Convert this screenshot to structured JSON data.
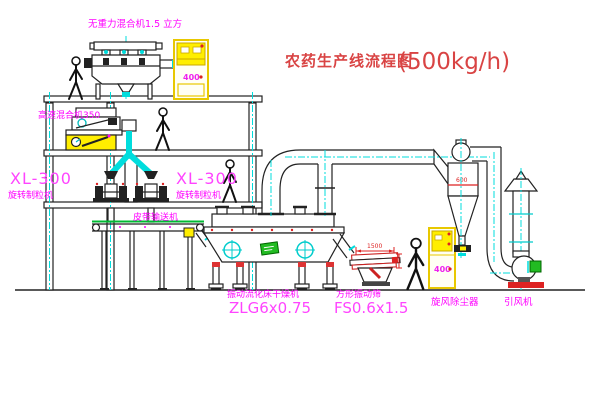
{
  "title": {
    "text_cn": "农药生产线流程图",
    "capacity": "(500kg/h)"
  },
  "labels": {
    "gravity_mixer": "无重力混合机1.5 立方",
    "high_speed_mixer": "高速混合机350",
    "granulator_left_model": "XL-300",
    "granulator_left_name": "旋转制粒机",
    "granulator_mid_model": "XL-300",
    "granulator_mid_name": "旋转制粒机",
    "belt_conveyor": "皮带输送机",
    "dryer_name": "振动流化床干燥机",
    "dryer_model": "ZLG6x0.75",
    "screen_name": "方形振动筛",
    "screen_model": "FS0.6x1.5",
    "cyclone": "旋风除尘器",
    "fan": "引风机"
  },
  "annotations": {
    "cabinet_top": "400",
    "cabinet_right": "400",
    "cyclone_dia": "600",
    "screen_width": "1500"
  },
  "colors": {
    "label_magenta": "#ff00ff",
    "title_red": "#d94444",
    "pipe_cyan": "#00dddd",
    "cabinet_yellow": "#ffee00",
    "machine_green": "#22bb22",
    "alert_red": "#dd2222",
    "line_black": "#222222"
  }
}
